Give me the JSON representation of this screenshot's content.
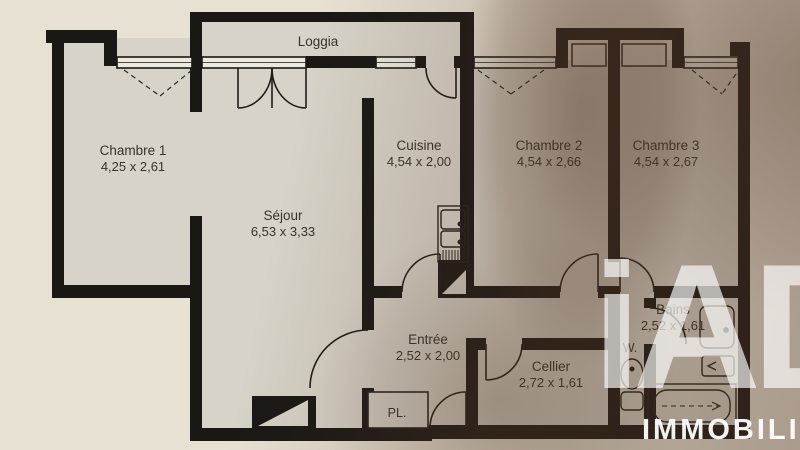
{
  "watermark": {
    "logo": "iAD",
    "brand": "IMMOBILIER"
  },
  "rooms": [
    {
      "id": "loggia",
      "name": "Loggia",
      "dims": ""
    },
    {
      "id": "chambre1",
      "name": "Chambre 1",
      "dims": "4,25 x 2,61"
    },
    {
      "id": "sejour",
      "name": "Séjour",
      "dims": "6,53 x 3,33"
    },
    {
      "id": "cuisine",
      "name": "Cuisine",
      "dims": "4,54 x 2,00"
    },
    {
      "id": "chambre2",
      "name": "Chambre 2",
      "dims": "4,54 x 2,66"
    },
    {
      "id": "chambre3",
      "name": "Chambre 3",
      "dims": "4,54 x 2,67"
    },
    {
      "id": "entree",
      "name": "Entrée",
      "dims": "2,52 x 2,00"
    },
    {
      "id": "cellier",
      "name": "Cellier",
      "dims": "2,72 x 1,61"
    },
    {
      "id": "bains",
      "name": "Bains",
      "dims": "2,52 x 1,61"
    },
    {
      "id": "wc",
      "name": "W."
    },
    {
      "id": "placard",
      "name": "PL."
    }
  ],
  "colors": {
    "paper": "#e7e1d4",
    "paper_shadowed": "#9f8a75",
    "room_fill": "#d7d3c8",
    "wall_ink": "#1a1815",
    "label_ink": "#36332c",
    "watermark": "#ffffff"
  }
}
